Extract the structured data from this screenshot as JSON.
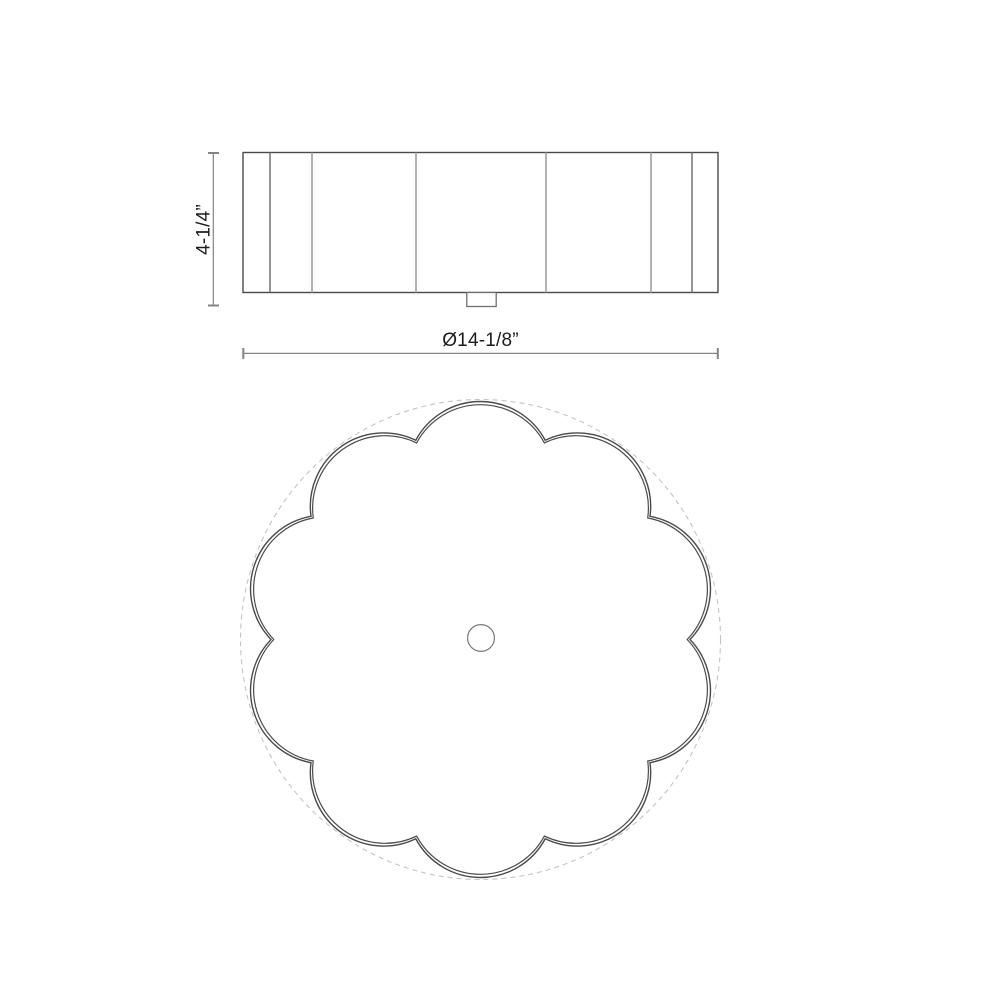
{
  "drawing": {
    "title": "Scalloped flush-mount ceiling fixture dimension drawing",
    "height_dimension": {
      "label": "4-1/4”"
    },
    "diameter_dimension": {
      "label": "Ø14-1/8”"
    },
    "plan_view": {
      "scallop_count": 10
    }
  },
  "colors": {
    "bg": "#ffffff",
    "outline": "#4a4a4a",
    "flute_light": "#9f9f9f",
    "flute_dark": "#686868",
    "mount": "#6f6f6f",
    "dim": "#848484",
    "dash": "#c4c4c4",
    "hole": "#7a7a7a",
    "text": "#1c1c1c"
  }
}
